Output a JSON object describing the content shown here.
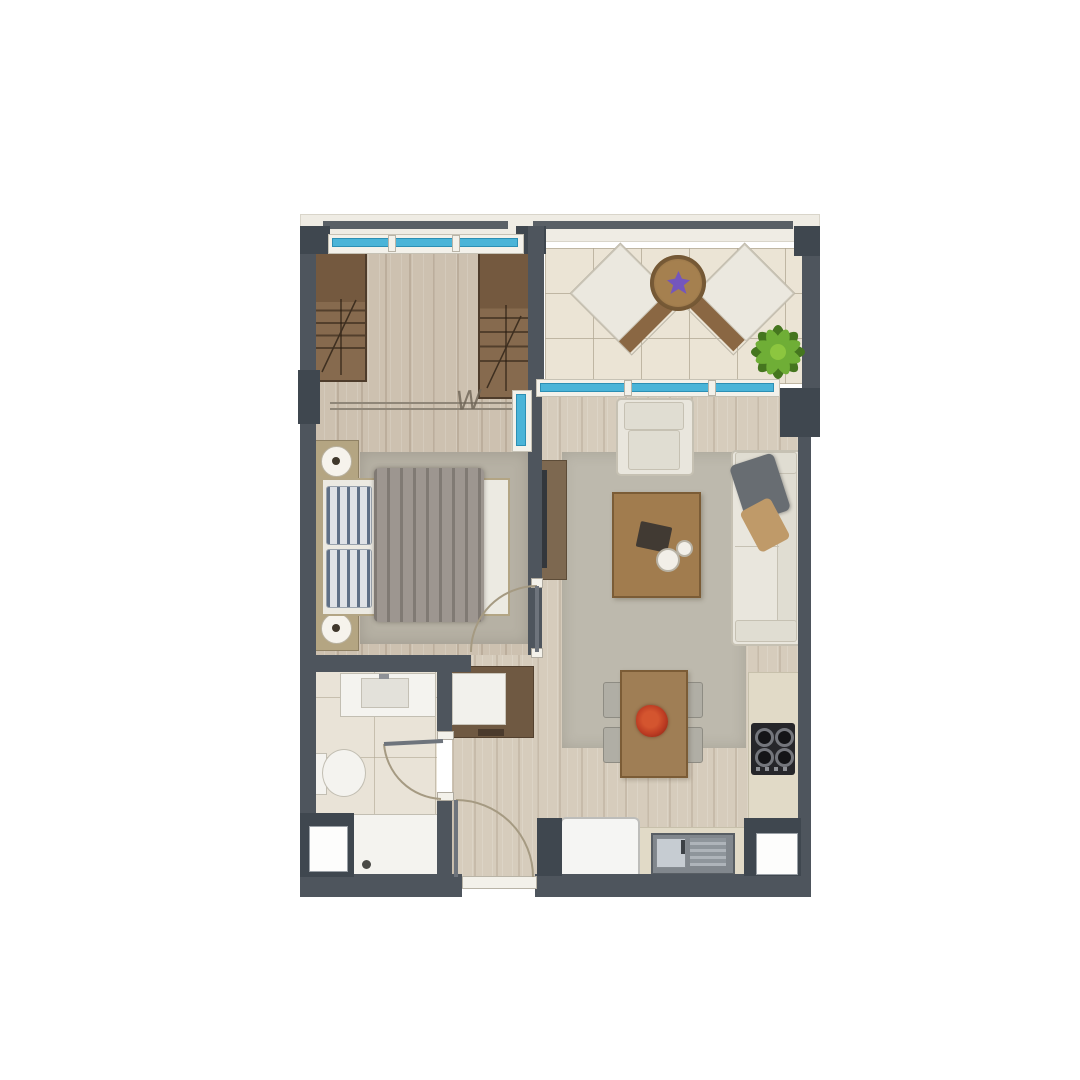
{
  "plan": {
    "kind": "apartment-floorplan-rendering",
    "rooms": [
      "bedroom",
      "dressing-area",
      "balcony",
      "living-room",
      "dining-area",
      "kitchen",
      "bathroom",
      "hallway"
    ],
    "furniture": {
      "bedroom": [
        "wardrobe-left",
        "wardrobe-right",
        "double-bed",
        "pillows",
        "blanket",
        "nightstand-top",
        "nightstand-bottom",
        "lamp-top",
        "lamp-bottom",
        "area-rug"
      ],
      "balcony": [
        "lounge-chair-left",
        "lounge-chair-right",
        "round-rattan-table",
        "potted-plant"
      ],
      "living-room": [
        "armchair",
        "coffee-table",
        "serving-tray",
        "cups",
        "sofa",
        "throw-blanket",
        "accent-pillow",
        "tv-unit",
        "tv",
        "area-rug"
      ],
      "dining-area": [
        "dining-table",
        "centerpiece-flowers",
        "chair-1",
        "chair-2",
        "chair-3",
        "chair-4"
      ],
      "kitchen": [
        "counter-right",
        "cooktop",
        "counter-bottom",
        "sink",
        "drainboard",
        "fridge"
      ],
      "bathroom": [
        "vanity-sink",
        "toilet",
        "shower"
      ],
      "hallway": [
        "entry-cabinet"
      ]
    },
    "openings": [
      "bedroom-door",
      "bathroom-door",
      "entrance-door",
      "bedroom-window",
      "balcony-sliding-window",
      "bedroom-side-window"
    ],
    "shafts": [
      "shaft-bottom-left",
      "shaft-bottom-right"
    ]
  },
  "marks": {
    "washer_symbol": "W"
  },
  "palette": {
    "wall": "#4e555d",
    "wall-dark": "#3f474f",
    "parapet": "#efece4",
    "parapet-bar": "#5a6066",
    "wood-bedroom": "#cdc1b0",
    "wood-living": "#d6ccbc",
    "tile-balcony": "#ebe4d5",
    "tile-bath": "#e9e3d7",
    "glass": "#4ab4d8",
    "glass-dark": "#2c8fb4",
    "frame-white": "#f3f1ea",
    "wardrobe": "#866a4e",
    "wardrobe-panel": "#74593f",
    "wardrobe-edge": "#4e3c2b",
    "nightstand": "#b4a582",
    "lamp": "#f6f3ec",
    "lamp-dot": "#40382c",
    "rug": "#b6b1a4",
    "rug-living": "#bdb9ad",
    "bed-frame": "#b3a584",
    "sheet": "#eceae2",
    "pillow-base": "#dfe2e6",
    "pillow-stripe": "#5f7086",
    "blanket": "#9d9690",
    "tv-unit": "#7d6850",
    "tv-screen": "#33373c",
    "sofa-body": "#e9e6dd",
    "sofa-inner": "#e0ddd2",
    "sofa-edge": "#c6c1b3",
    "throw": "#686d72",
    "pillow-tan": "#bf9a69",
    "coffee-table": "#a17c4e",
    "table-edge": "#7b5c36",
    "tray": "#413a33",
    "cup": "#f2efe8",
    "dining-table": "#9f7e55",
    "chair": "#b0aea5",
    "chair-edge": "#8e8c83",
    "flowers-red": "#bc3b22",
    "flowers-dark": "#7c1f10",
    "counter": "#e1dac7",
    "counter-edge": "#c7c0ab",
    "cooktop": "#26262a",
    "fridge": "#f5f5f3",
    "fridge-edge": "#bdbdba",
    "sink-recess": "#81878d",
    "steel": "#c6ccd2",
    "fixture-white": "#f4f3ef",
    "fixture-edge": "#c2beb2",
    "drain": "#4a4a46",
    "shaft": "#fdfdfc",
    "cabinet-brown": "#6f5942",
    "cabinet-white": "#f2f1ec",
    "balc-cushion": "#ebe8df",
    "balc-wood": "#8a6743",
    "rattan-dark": "#6e5231",
    "flower-purple": "#7456bd",
    "plant-green": "#6fae36",
    "plant-dark": "#45761f",
    "divider": "#8f8678",
    "arc-stroke": "#a59a82",
    "door-leaf": "#6e747c",
    "w-mark": "#6e6456"
  }
}
